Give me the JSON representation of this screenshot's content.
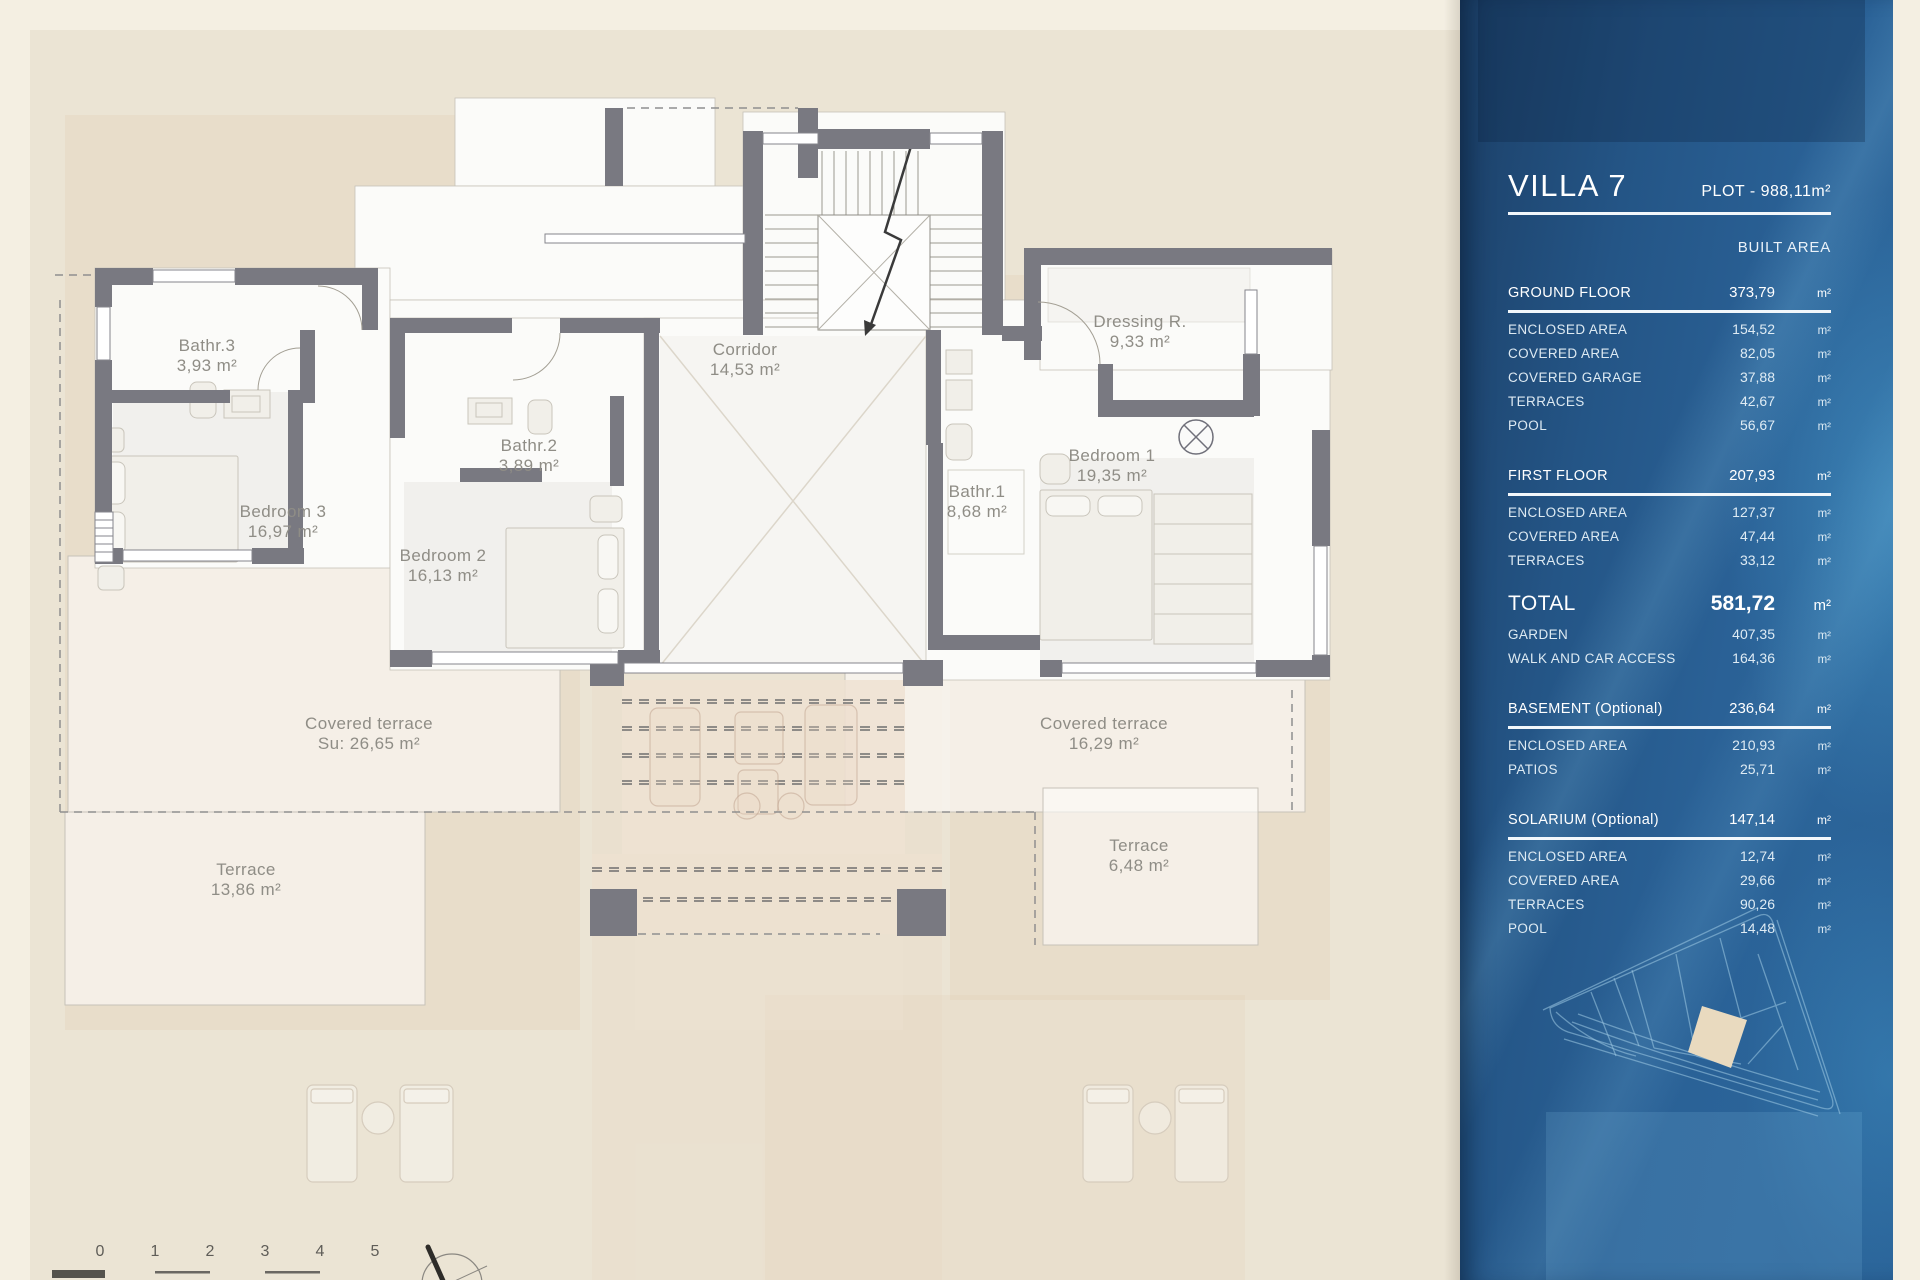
{
  "plan": {
    "labels": [
      {
        "id": "bathr3",
        "name": "Bathr.3",
        "area": "3,93 m²"
      },
      {
        "id": "bedroom3",
        "name": "Bedroom 3",
        "area": "16,97 m²"
      },
      {
        "id": "bathr2",
        "name": "Bathr.2",
        "area": "3,89 m²"
      },
      {
        "id": "bedroom2",
        "name": "Bedroom 2",
        "area": "16,13 m²"
      },
      {
        "id": "corridor",
        "name": "Corridor",
        "area": "14,53 m²"
      },
      {
        "id": "dressing",
        "name": "Dressing R.",
        "area": "9,33 m²"
      },
      {
        "id": "bathr1",
        "name": "Bathr.1",
        "area": "8,68 m²"
      },
      {
        "id": "bedroom1",
        "name": "Bedroom 1",
        "area": "19,35 m²"
      },
      {
        "id": "covered-terrace-left",
        "name": "Covered terrace",
        "area": "Su: 26,65 m²"
      },
      {
        "id": "terrace-left",
        "name": "Terrace",
        "area": "13,86 m²"
      },
      {
        "id": "covered-terrace-right",
        "name": "Covered terrace",
        "area": "16,29 m²"
      },
      {
        "id": "terrace-right",
        "name": "Terrace",
        "area": "6,48 m²"
      }
    ],
    "scale_numbers": [
      "0",
      "1",
      "2",
      "3",
      "4",
      "5"
    ]
  },
  "sidebar": {
    "title": "VILLA 7",
    "plot_label": "PLOT - 988,11m²",
    "built_area_label": "BUILT AREA",
    "colors": {
      "accent_blue": "#2a6196",
      "panel_dark": "#1c4068",
      "plot_highlight": "#e9dabf"
    },
    "sections": [
      {
        "style": "header",
        "label": "GROUND FLOOR",
        "value": "373,79",
        "unit": "m²",
        "rows": [
          {
            "label": "ENCLOSED AREA",
            "value": "154,52",
            "unit": "m²"
          },
          {
            "label": "COVERED AREA",
            "value": "82,05",
            "unit": "m²"
          },
          {
            "label": "COVERED GARAGE",
            "value": "37,88",
            "unit": "m²"
          },
          {
            "label": "TERRACES",
            "value": "42,67",
            "unit": "m²"
          },
          {
            "label": "POOL",
            "value": "56,67",
            "unit": "m²"
          }
        ]
      },
      {
        "style": "header",
        "label": "FIRST FLOOR",
        "value": "207,93",
        "unit": "m²",
        "rows": [
          {
            "label": "ENCLOSED AREA",
            "value": "127,37",
            "unit": "m²"
          },
          {
            "label": "COVERED AREA",
            "value": "47,44",
            "unit": "m²"
          },
          {
            "label": "TERRACES",
            "value": "33,12",
            "unit": "m²"
          }
        ]
      },
      {
        "style": "total",
        "label": "TOTAL",
        "value": "581,72",
        "unit": "m²",
        "rows": [
          {
            "label": "GARDEN",
            "value": "407,35",
            "unit": "m²"
          },
          {
            "label": "WALK AND CAR ACCESS",
            "value": "164,36",
            "unit": "m²"
          }
        ]
      },
      {
        "style": "header",
        "label": "BASEMENT (Optional)",
        "value": "236,64",
        "unit": "m²",
        "rows": [
          {
            "label": "ENCLOSED AREA",
            "value": "210,93",
            "unit": "m²"
          },
          {
            "label": "PATIOS",
            "value": "25,71",
            "unit": "m²"
          }
        ]
      },
      {
        "style": "header",
        "label": "SOLARIUM (Optional)",
        "value": "147,14",
        "unit": "m²",
        "rows": [
          {
            "label": "ENCLOSED AREA",
            "value": "12,74",
            "unit": "m²"
          },
          {
            "label": "COVERED AREA",
            "value": "29,66",
            "unit": "m²"
          },
          {
            "label": "TERRACES",
            "value": "90,26",
            "unit": "m²"
          },
          {
            "label": "POOL",
            "value": "14,48",
            "unit": "m²"
          }
        ]
      }
    ]
  }
}
